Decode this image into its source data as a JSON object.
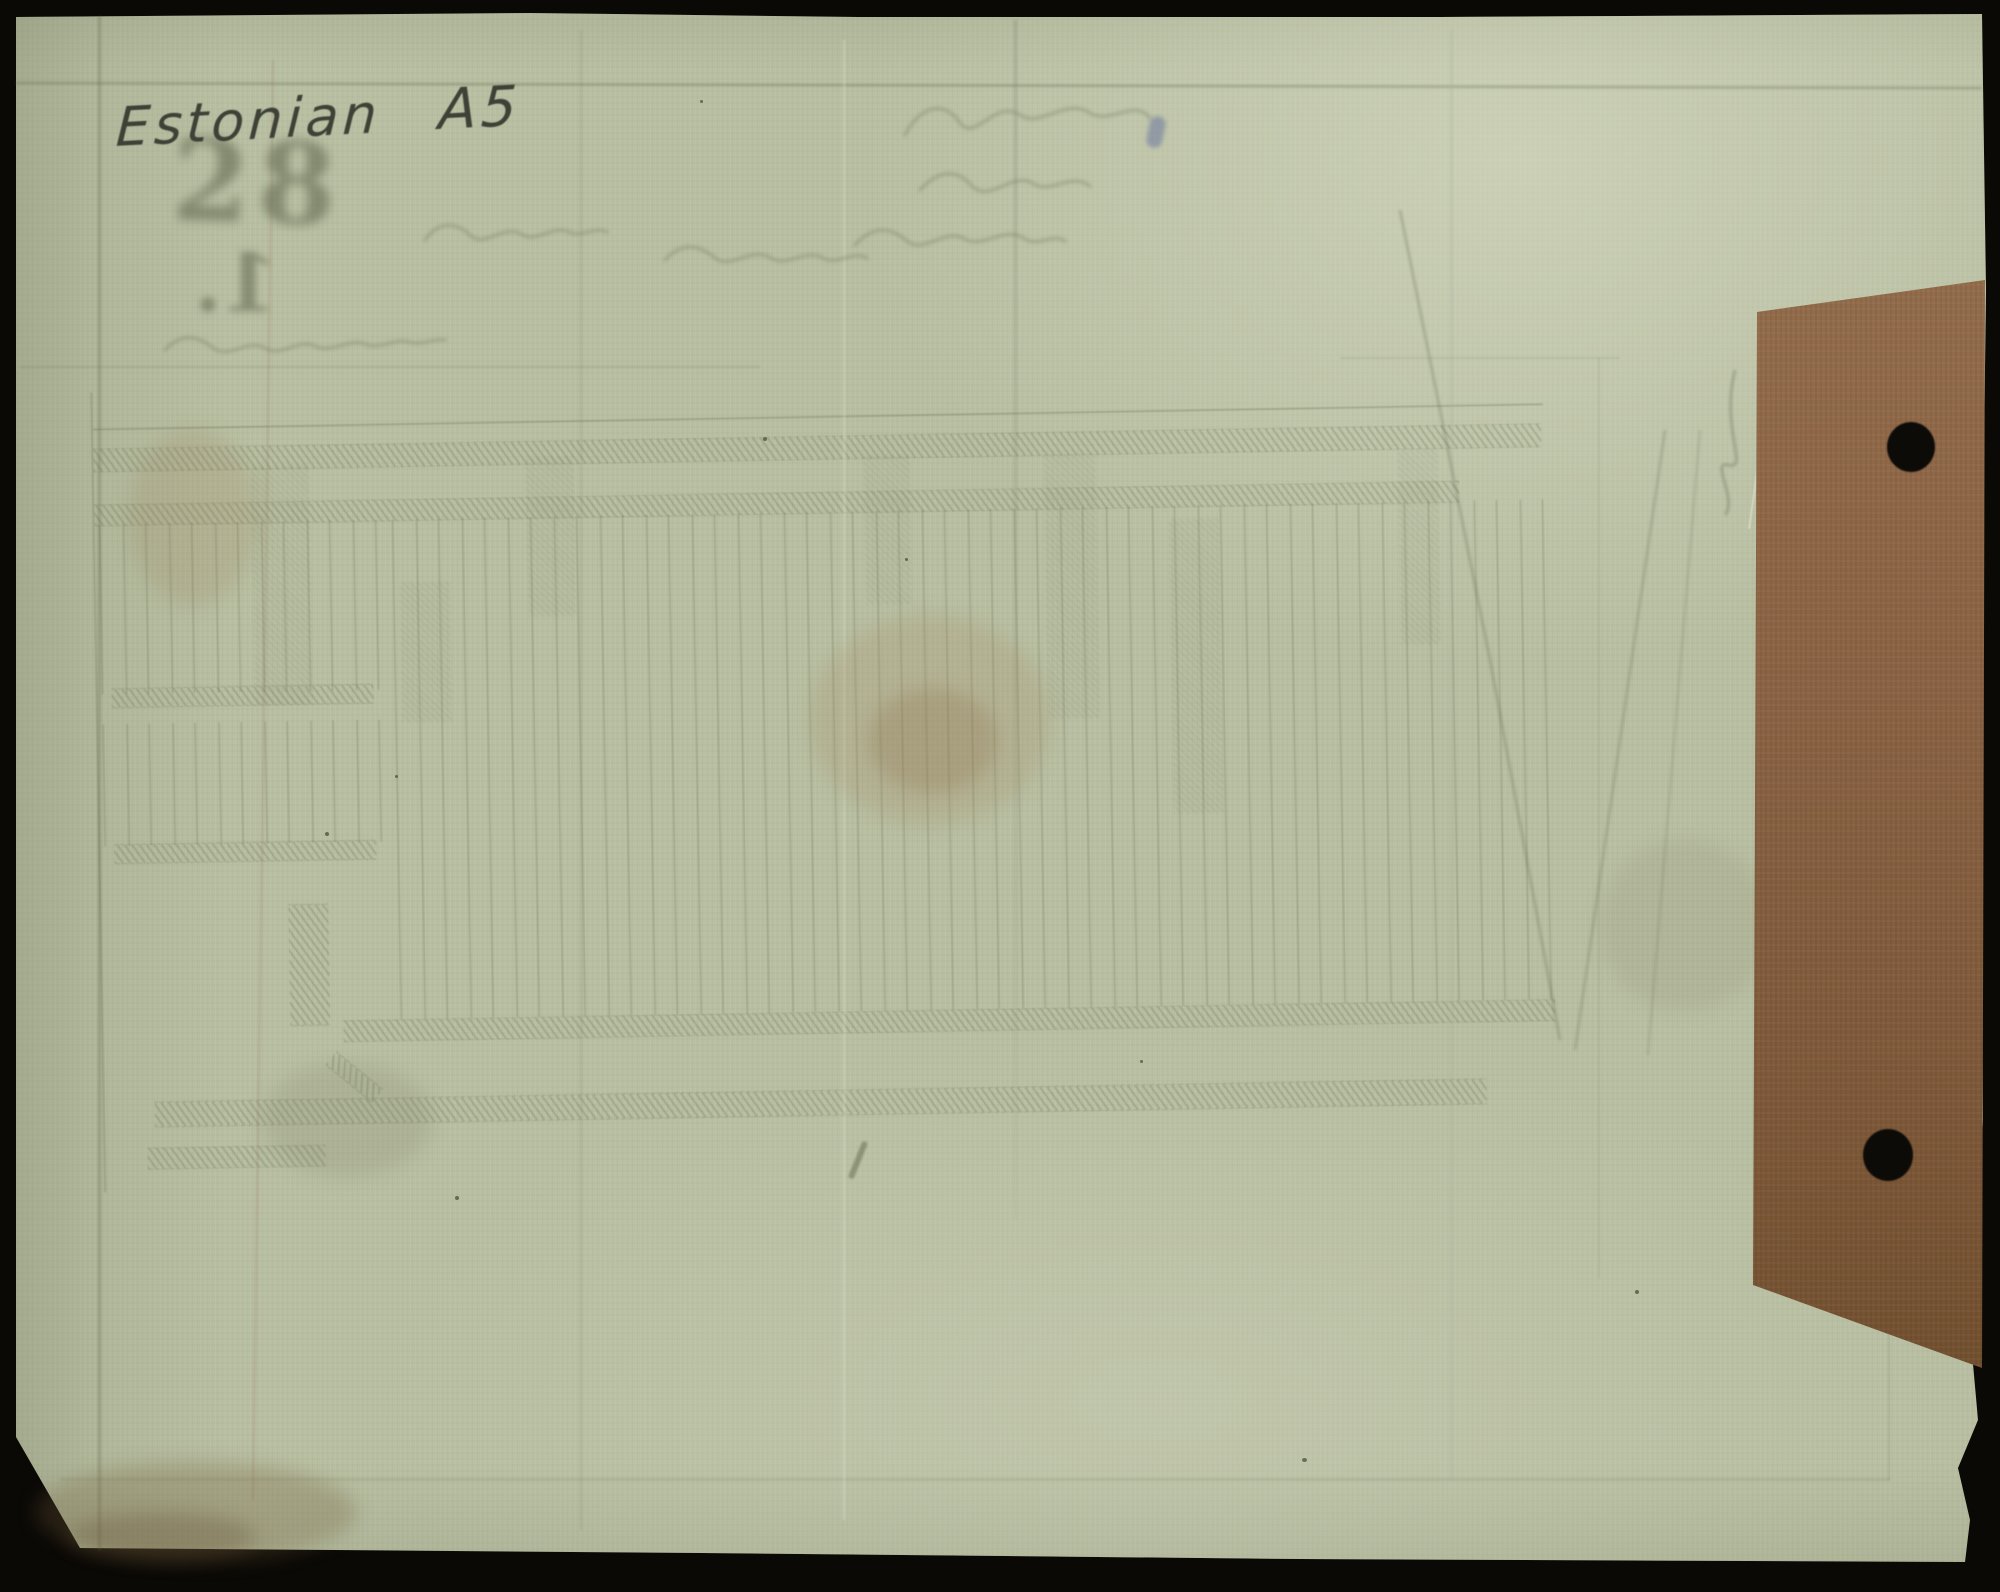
{
  "annotation": {
    "language": "Estonian",
    "format": "A5"
  },
  "ghost_marks": {
    "stamp_number": "28",
    "item_number": "1."
  },
  "colors": {
    "scan-background": "#0b0906",
    "paper": "#b9bfa2",
    "paper-light": "#cdd1b7",
    "paper-shadow": "#9ba381",
    "ghost-print": "#6d7854",
    "pencil": "#3d4136",
    "cardboard": "#8a6243",
    "cardboard-dark": "#72502f",
    "punch-hole": "#0d0b08"
  }
}
